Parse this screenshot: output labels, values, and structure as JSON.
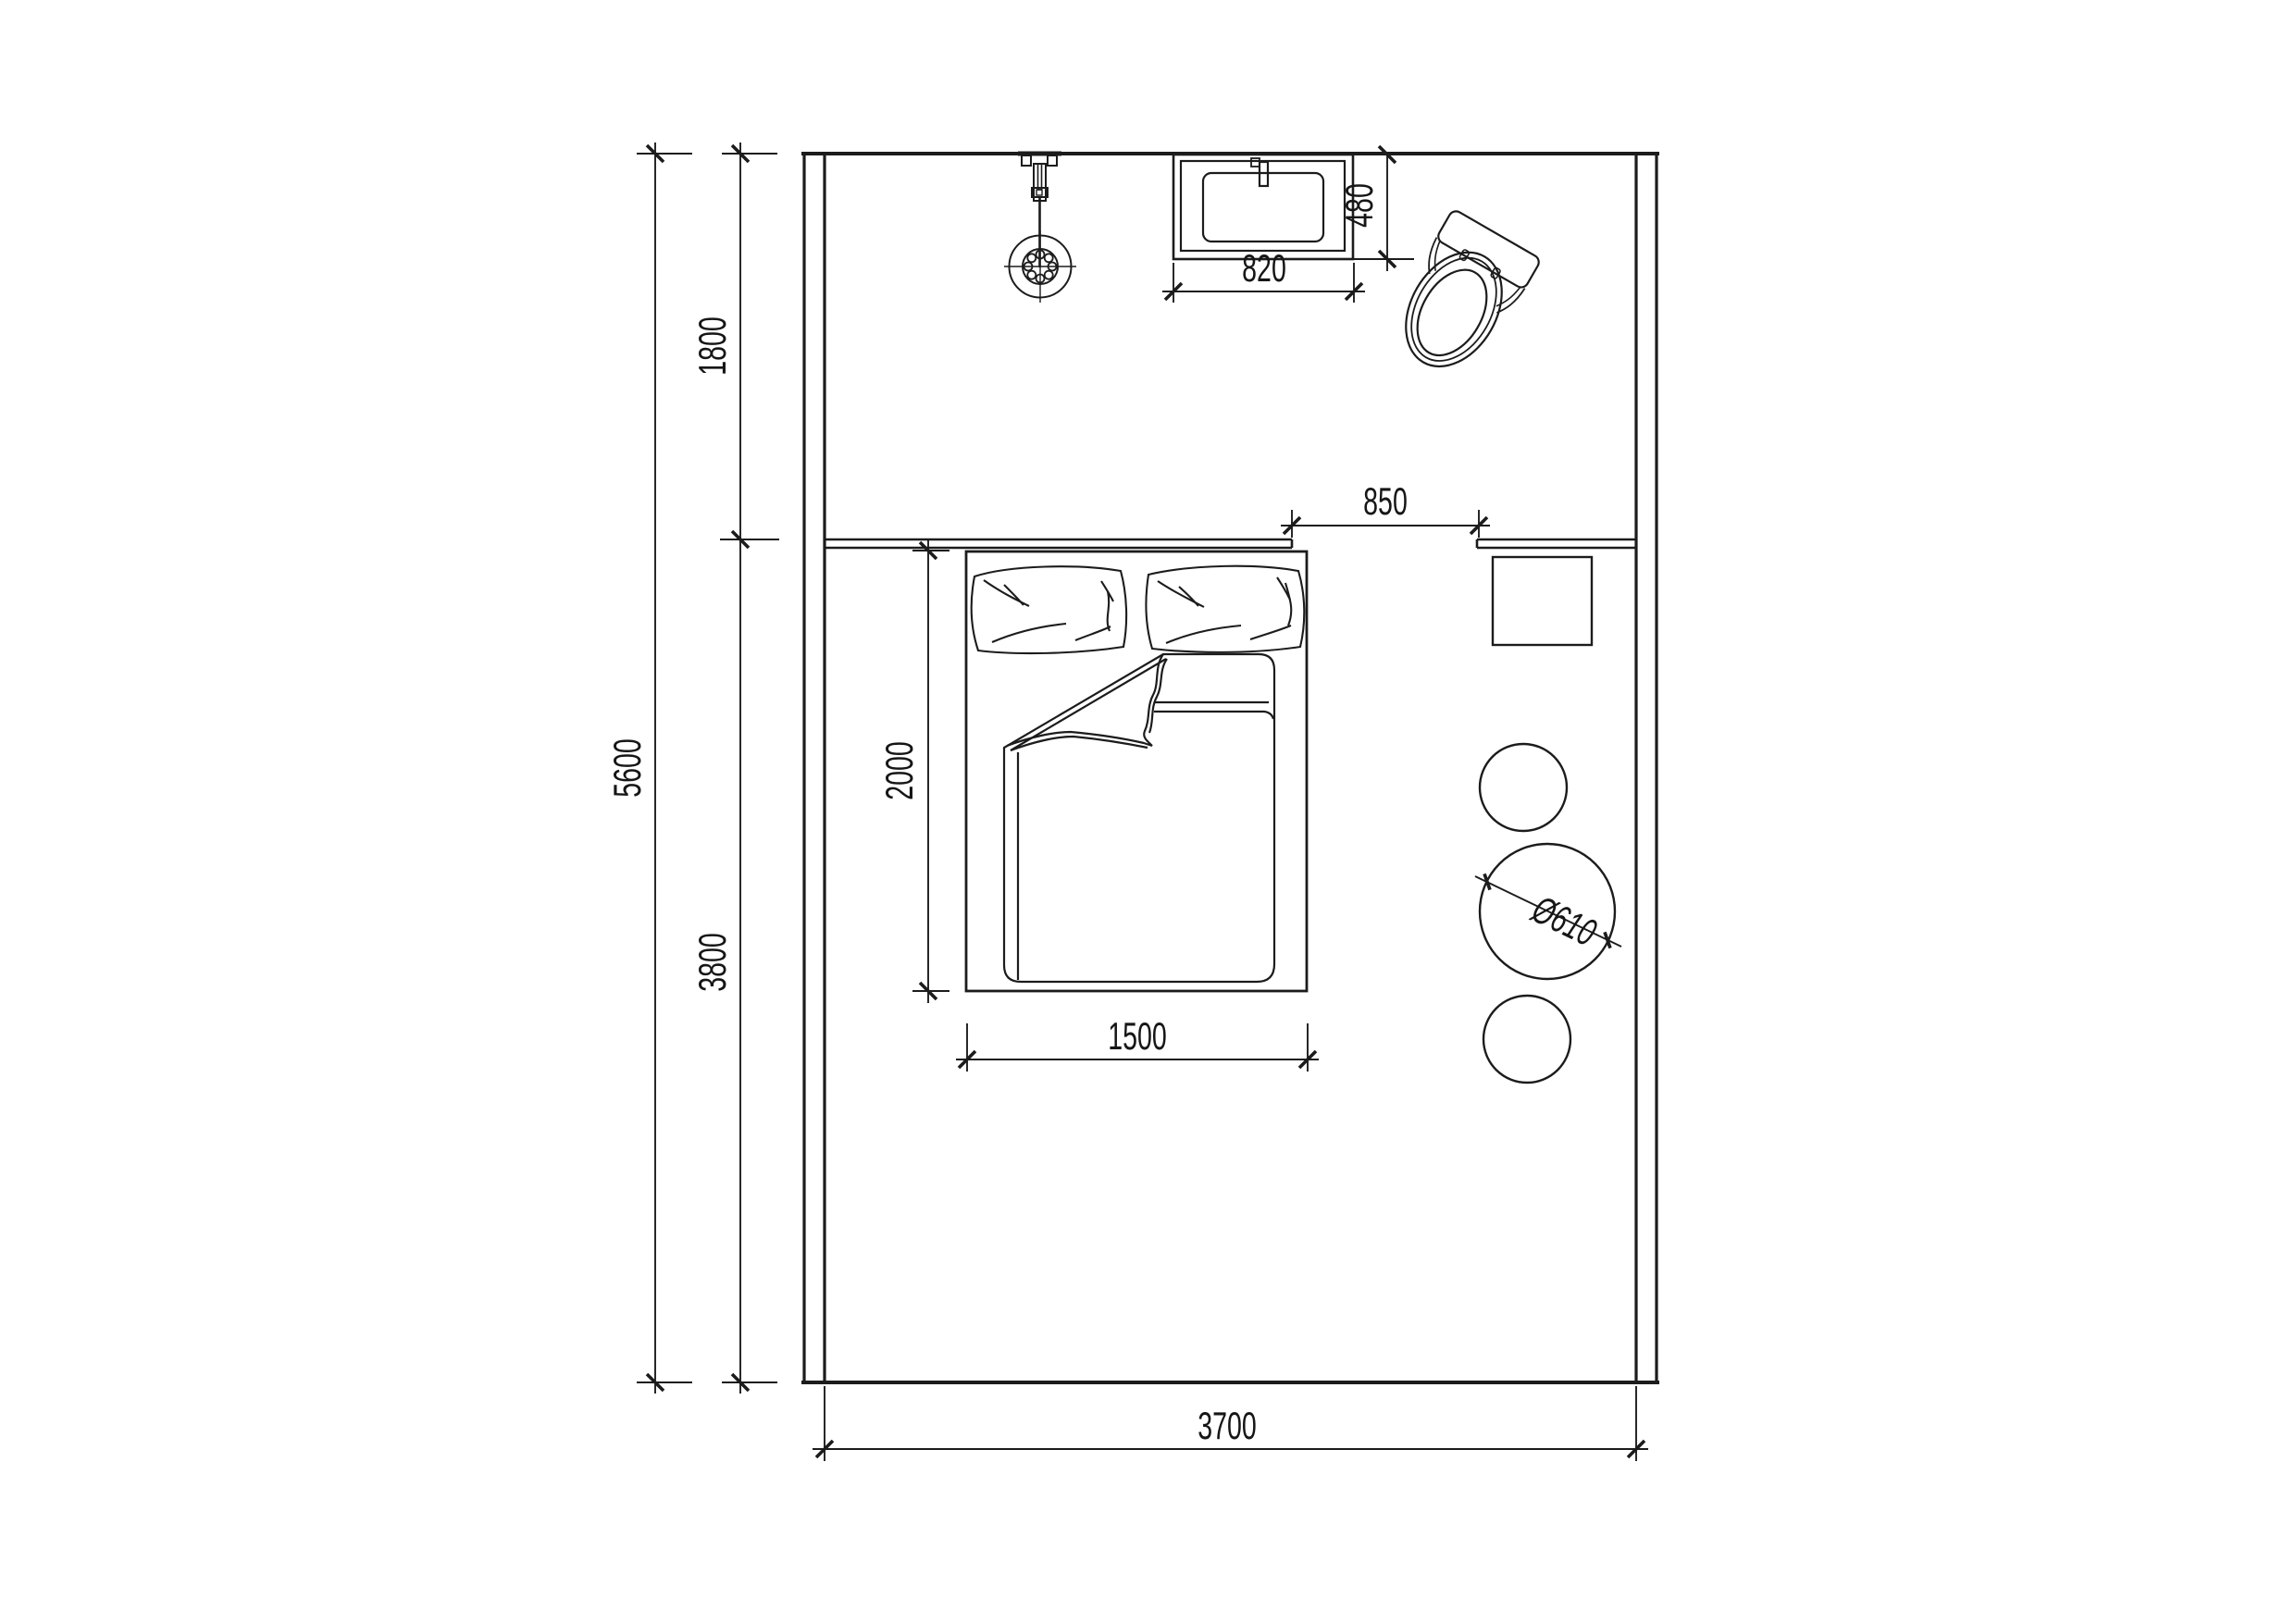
{
  "drawing": {
    "type": "architectural floor plan, bedroom with bath fixtures",
    "colors": {
      "line": "#1c1c1c",
      "background": "#ffffff",
      "text": "#161616"
    },
    "dimensions": {
      "room_width": "3700",
      "room_height_total": "5600",
      "zone_top_depth": "1800",
      "zone_bottom_depth": "3800",
      "bed_length": "2000",
      "bed_width": "1500",
      "headboard_gap": "850",
      "basin_width": "820",
      "basin_depth": "480",
      "table_diameter": "Ø610"
    },
    "symbols": {
      "shower": "shower-head-symbol",
      "basin": "wash-basin-symbol",
      "toilet": "toilet-symbol",
      "bed": "double-bed-symbol",
      "nightstand": "square-table-symbol",
      "round_tables": "circular-stool-symbols"
    }
  }
}
